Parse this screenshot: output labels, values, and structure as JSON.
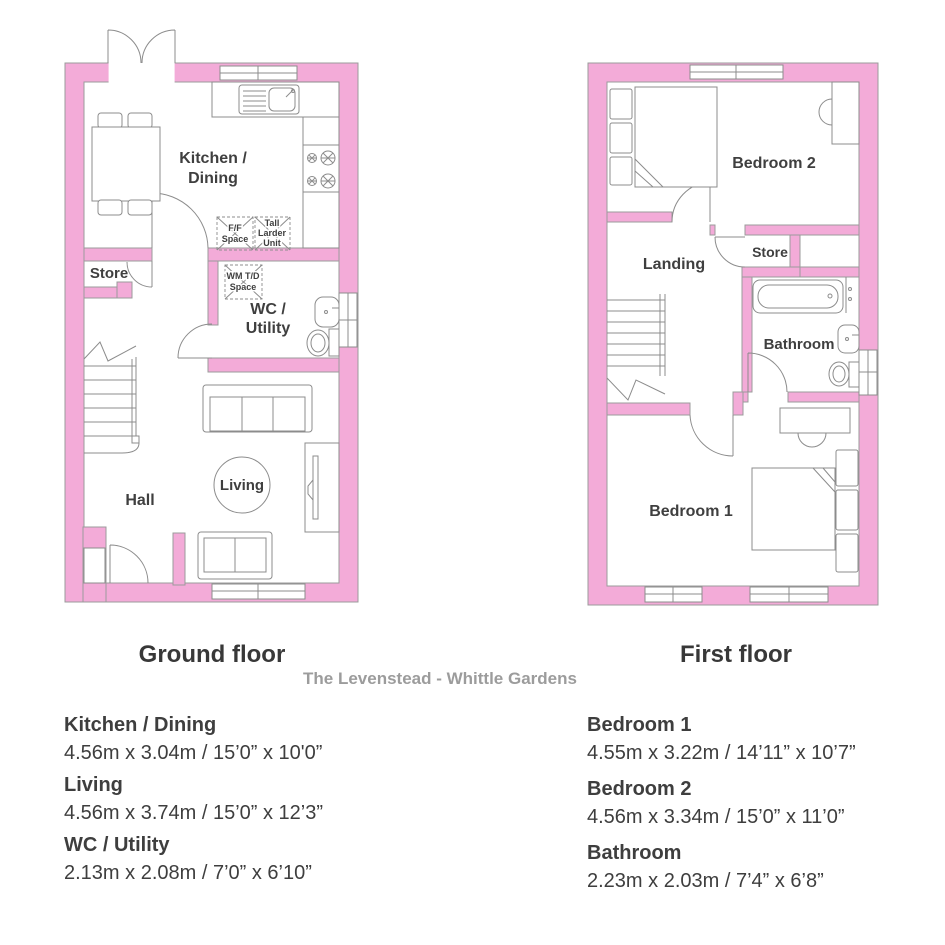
{
  "page": {
    "subtitle": "The Levenstead - Whittle Gardens"
  },
  "colors": {
    "wall_pink": "#F3ABD8",
    "outline": "#9B9B9B",
    "furniture": "#8C8C8C",
    "label_text": "#3F3F3F",
    "title_text": "#383838",
    "subtitle_gray": "#9C9C9C",
    "dim_text": "#3E3E3E"
  },
  "ground_floor": {
    "title": "Ground floor",
    "labels": {
      "kitchen_l1": "Kitchen /",
      "kitchen_l2": "Dining",
      "store": "Store",
      "wc_l1": "WC /",
      "wc_l2": "Utility",
      "hall": "Hall",
      "living": "Living",
      "ff_l1": "F/F",
      "ff_l2": "Space",
      "larder_l1": "Tall",
      "larder_l2": "Larder",
      "larder_l3": "Unit",
      "wm_l1": "WM T/D",
      "wm_l2": "Space"
    },
    "dimensions": [
      {
        "room": "Kitchen / Dining",
        "size": "4.56m x 3.04m / 15’0” x 10'0”"
      },
      {
        "room": "Living",
        "size": "4.56m x 3.74m / 15’0” x 12’3”"
      },
      {
        "room": "WC / Utility",
        "size": "2.13m x 2.08m / 7’0” x 6’10”"
      }
    ]
  },
  "first_floor": {
    "title": "First floor",
    "labels": {
      "bedroom2": "Bedroom 2",
      "landing": "Landing",
      "store": "Store",
      "bathroom": "Bathroom",
      "bedroom1": "Bedroom 1"
    },
    "dimensions": [
      {
        "room": "Bedroom 1",
        "size": "4.55m x 3.22m / 14’11” x 10’7”"
      },
      {
        "room": "Bedroom 2",
        "size": "4.56m x 3.34m / 15’0” x 11’0”"
      },
      {
        "room": "Bathroom",
        "size": "2.23m x 2.03m / 7’4” x 6’8”"
      }
    ]
  }
}
